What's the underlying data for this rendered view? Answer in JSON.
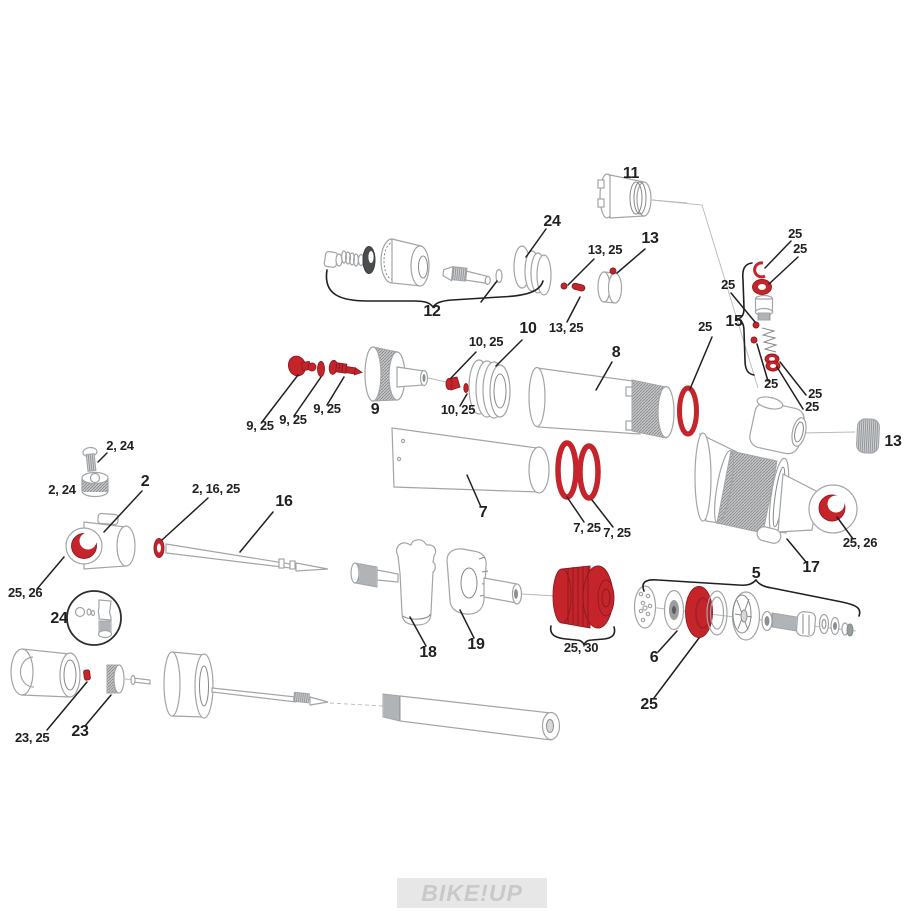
{
  "diagram": {
    "type": "exploded-parts-diagram",
    "subject": "rear-shock-exploded-view",
    "watermark": "BIKE!UP",
    "colors": {
      "highlight": "#c5242b",
      "highlight_dark": "#8e1a20",
      "linework": "#a2a5a7",
      "label": "#231f20",
      "watermark": "#c9c9c9"
    },
    "labels": [
      {
        "id": "11",
        "text": "11"
      },
      {
        "id": "24-top",
        "text": "24"
      },
      {
        "id": "12",
        "text": "12"
      },
      {
        "id": "13-25-top",
        "text": "13, 25"
      },
      {
        "id": "13-top",
        "text": "13"
      },
      {
        "id": "13-25-mid",
        "text": "13, 25"
      },
      {
        "id": "25-circlip",
        "text": "25"
      },
      {
        "id": "25-oring-15",
        "text": "25"
      },
      {
        "id": "25-pin-1",
        "text": "25"
      },
      {
        "id": "15",
        "text": "15"
      },
      {
        "id": "25-body-oring",
        "text": "25"
      },
      {
        "id": "25-pin-2",
        "text": "25"
      },
      {
        "id": "25-glide-1",
        "text": "25"
      },
      {
        "id": "25-glide-2",
        "text": "25"
      },
      {
        "id": "8",
        "text": "8"
      },
      {
        "id": "10-25-top",
        "text": "10, 25"
      },
      {
        "id": "10",
        "text": "10"
      },
      {
        "id": "10-25-bottom",
        "text": "10, 25"
      },
      {
        "id": "9-25-a",
        "text": "9, 25"
      },
      {
        "id": "9-25-b",
        "text": "9, 25"
      },
      {
        "id": "9-25-c",
        "text": "9, 25"
      },
      {
        "id": "9",
        "text": "9"
      },
      {
        "id": "13-right",
        "text": "13"
      },
      {
        "id": "2-24-top",
        "text": "2, 24"
      },
      {
        "id": "2-24-left",
        "text": "2, 24"
      },
      {
        "id": "2",
        "text": "2"
      },
      {
        "id": "2-16-25",
        "text": "2, 16, 25"
      },
      {
        "id": "16",
        "text": "16"
      },
      {
        "id": "25-26-left",
        "text": "25, 26"
      },
      {
        "id": "24-circle",
        "text": "24"
      },
      {
        "id": "7",
        "text": "7"
      },
      {
        "id": "7-25-a",
        "text": "7, 25"
      },
      {
        "id": "7-25-b",
        "text": "7, 25"
      },
      {
        "id": "18",
        "text": "18"
      },
      {
        "id": "19",
        "text": "19"
      },
      {
        "id": "25-30",
        "text": "25, 30"
      },
      {
        "id": "5",
        "text": "5"
      },
      {
        "id": "17",
        "text": "17"
      },
      {
        "id": "6",
        "text": "6"
      },
      {
        "id": "25-seal",
        "text": "25"
      },
      {
        "id": "25-26-right",
        "text": "25, 26"
      },
      {
        "id": "23-25",
        "text": "23, 25"
      },
      {
        "id": "23",
        "text": "23"
      }
    ]
  }
}
